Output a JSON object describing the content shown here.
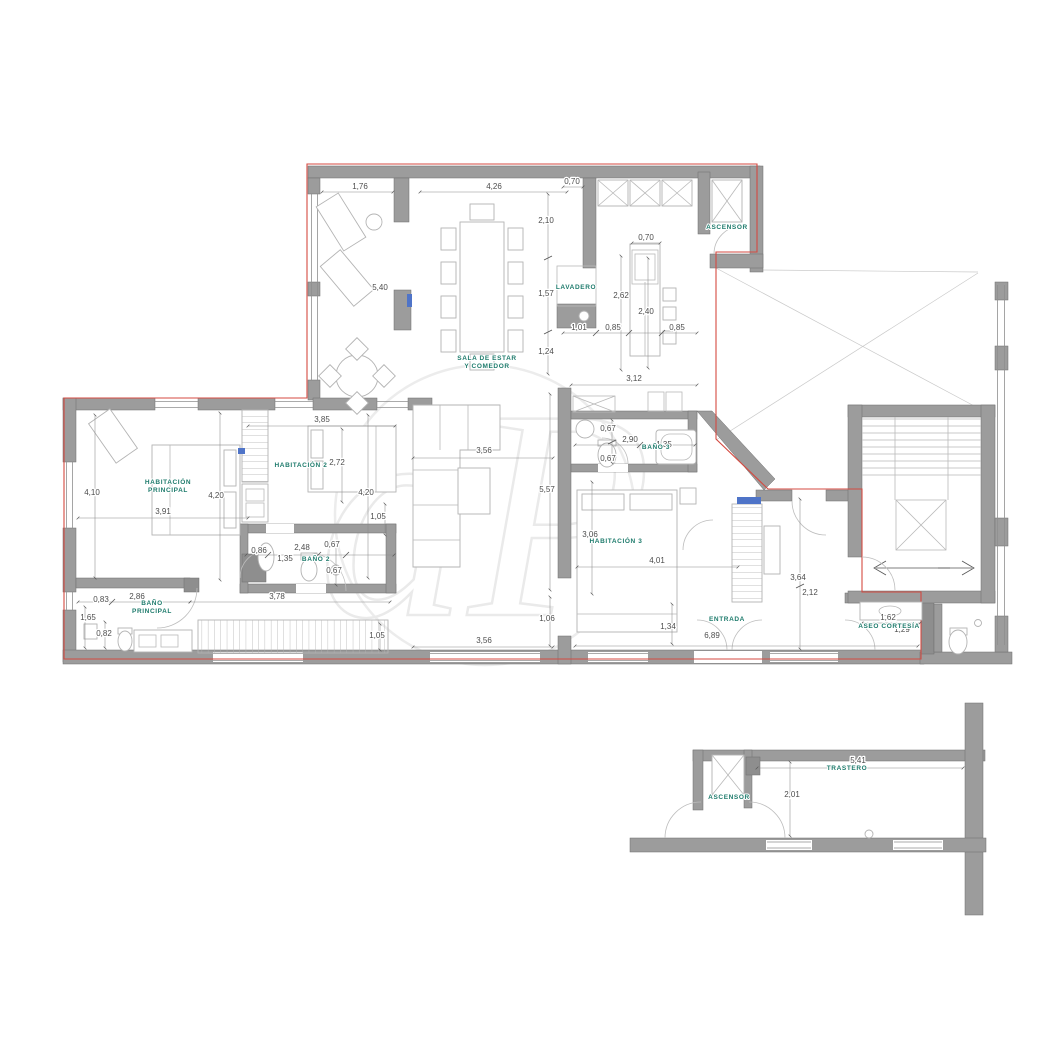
{
  "meta": {
    "colors": {
      "wall": "#9c9c9c",
      "boundary_red": "#d44a41",
      "label_teal": "#1e7b6c",
      "dim_gray": "#4d4d4d",
      "furniture": "#b3b3b3",
      "accent_blue": "#4f74c8"
    }
  },
  "watermark": {
    "text": "aP"
  },
  "rooms": [
    {
      "name": "sala-de-estar",
      "label": "SALA DE ESTAR\nY COMEDOR",
      "x": 487,
      "y": 360,
      "s": 6
    },
    {
      "name": "ascensor-top",
      "label": "ASCENSOR",
      "x": 727,
      "y": 229,
      "s": 5
    },
    {
      "name": "lavadero",
      "label": "LAVADERO",
      "x": 576,
      "y": 289,
      "s": 4.2
    },
    {
      "name": "habitacion-principal",
      "label": "HABITACIÓN\nPRINCIPAL",
      "x": 168,
      "y": 484,
      "s": 6
    },
    {
      "name": "habitacion-2",
      "label": "HABITACIÓN 2",
      "x": 301,
      "y": 467,
      "s": 6
    },
    {
      "name": "bano-2",
      "label": "BAÑO 2",
      "x": 316,
      "y": 561,
      "s": 5.2
    },
    {
      "name": "bano-principal",
      "label": "BAÑO\nPRINCIPAL",
      "x": 152,
      "y": 605,
      "s": 6
    },
    {
      "name": "habitacion-3",
      "label": "HABITACIÓN 3",
      "x": 616,
      "y": 543,
      "s": 6
    },
    {
      "name": "bano-3",
      "label": "BAÑO 3",
      "x": 656,
      "y": 449,
      "s": 5.2
    },
    {
      "name": "entrada",
      "label": "ENTRADA",
      "x": 727,
      "y": 621,
      "s": 6.5
    },
    {
      "name": "aseo-cortesia",
      "label": "ASEO CORTESÍA",
      "x": 889,
      "y": 628,
      "s": 5.2
    },
    {
      "name": "ascensor-bottom",
      "label": "ASCENSOR",
      "x": 729,
      "y": 799,
      "s": 5
    },
    {
      "name": "trastero",
      "label": "TRASTERO",
      "x": 847,
      "y": 770,
      "s": 5.5
    }
  ],
  "dimensions": [
    {
      "v": "1,76",
      "x": 360,
      "y": 189
    },
    {
      "v": "4,26",
      "x": 494,
      "y": 189
    },
    {
      "v": "0,70",
      "x": 572,
      "y": 184
    },
    {
      "v": "2,10",
      "x": 546,
      "y": 223
    },
    {
      "v": "0,70",
      "x": 646,
      "y": 240
    },
    {
      "v": "5,40",
      "x": 380,
      "y": 290
    },
    {
      "v": "1,57",
      "x": 546,
      "y": 296
    },
    {
      "v": "2,62",
      "x": 621,
      "y": 298
    },
    {
      "v": "2,40",
      "x": 646,
      "y": 314
    },
    {
      "v": "1,24",
      "x": 546,
      "y": 354
    },
    {
      "v": "1,01",
      "x": 579,
      "y": 330
    },
    {
      "v": "0,85",
      "x": 613,
      "y": 330
    },
    {
      "v": "0,85",
      "x": 677,
      "y": 330
    },
    {
      "v": "3,12",
      "x": 634,
      "y": 381
    },
    {
      "v": "3,85",
      "x": 322,
      "y": 422
    },
    {
      "v": "2,72",
      "x": 337,
      "y": 465
    },
    {
      "v": "4,10",
      "x": 92,
      "y": 495
    },
    {
      "v": "4,20",
      "x": 216,
      "y": 498
    },
    {
      "v": "4,20",
      "x": 366,
      "y": 495
    },
    {
      "v": "3,91",
      "x": 163,
      "y": 514
    },
    {
      "v": "1,05",
      "x": 378,
      "y": 519
    },
    {
      "v": "3,56",
      "x": 484,
      "y": 453
    },
    {
      "v": "5,57",
      "x": 547,
      "y": 492
    },
    {
      "v": "0,67",
      "x": 608,
      "y": 431
    },
    {
      "v": "2,90",
      "x": 630,
      "y": 442
    },
    {
      "v": "1,35",
      "x": 664,
      "y": 447
    },
    {
      "v": "0,67",
      "x": 608,
      "y": 461
    },
    {
      "v": "3,06",
      "x": 590,
      "y": 537
    },
    {
      "v": "4,01",
      "x": 657,
      "y": 563
    },
    {
      "v": "0,86",
      "x": 259,
      "y": 553
    },
    {
      "v": "2,48",
      "x": 302,
      "y": 550
    },
    {
      "v": "0,67",
      "x": 332,
      "y": 547
    },
    {
      "v": "1,35",
      "x": 285,
      "y": 561
    },
    {
      "v": "0,67",
      "x": 334,
      "y": 573
    },
    {
      "v": "0,83",
      "x": 101,
      "y": 602
    },
    {
      "v": "2,86",
      "x": 137,
      "y": 599
    },
    {
      "v": "3,78",
      "x": 277,
      "y": 599
    },
    {
      "v": "1,65",
      "x": 88,
      "y": 620
    },
    {
      "v": "0,82",
      "x": 104,
      "y": 636
    },
    {
      "v": "1,05",
      "x": 377,
      "y": 638
    },
    {
      "v": "1,06",
      "x": 547,
      "y": 621
    },
    {
      "v": "3,56",
      "x": 484,
      "y": 643
    },
    {
      "v": "1,34",
      "x": 668,
      "y": 629
    },
    {
      "v": "6,89",
      "x": 712,
      "y": 638
    },
    {
      "v": "3,64",
      "x": 798,
      "y": 580
    },
    {
      "v": "2,12",
      "x": 810,
      "y": 595
    },
    {
      "v": "1,62",
      "x": 888,
      "y": 620
    },
    {
      "v": "1,29",
      "x": 902,
      "y": 632
    },
    {
      "v": "5,41",
      "x": 858,
      "y": 763
    },
    {
      "v": "2,01",
      "x": 792,
      "y": 797
    }
  ]
}
